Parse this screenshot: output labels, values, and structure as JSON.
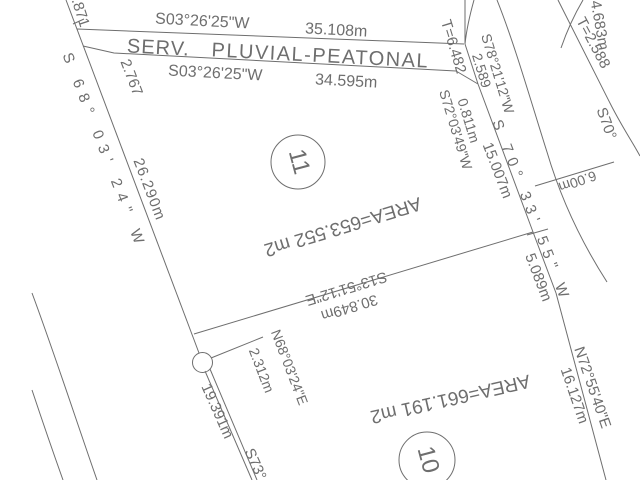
{
  "colors": {
    "line": "#6e6e6e",
    "text": "#6e6e6e",
    "background": "#ffffff"
  },
  "easement": {
    "name_1": "SERV.",
    "name_2": "PLUVIAL-PEATONAL",
    "north_bearing": "S03°26'25\"W",
    "north_distance": "35.108m",
    "south_bearing": "S03°26'25\"W",
    "south_distance": "34.595m"
  },
  "lots": [
    {
      "number": "11",
      "area": "AREA=653.552 m2"
    },
    {
      "number": "10",
      "area": "AREA=661.191 m2"
    }
  ],
  "measurements": {
    "west_cut_number": ".871",
    "west_bearing": "S 68° 03' 24\" W",
    "west_distance": "26.290m",
    "west_tie": "2.767",
    "corner_tangent": "T=6.482",
    "corner_bearing_1": "S78°21'12\"W",
    "corner_distance_1": "2.589",
    "corner_distance_2": "0.811m",
    "corner_bearing_2": "S72°03'49\"W",
    "east_bearing": "S 70° 33' 55\" W",
    "east_distance_1": "15.007m",
    "east_distance_2": "5.089m",
    "division_bearing": "S13°51'12\"E",
    "division_distance": "30.849m",
    "tie_bearing": "N68°03'24\"E",
    "tie_distance": "2.312m",
    "southwest_distance": "19.391m",
    "southwest_bearing_cut": "S73°",
    "southeast_bearing": "N72°55'40\"E",
    "southeast_distance": "16.127m",
    "road_tangent": "T=2.588",
    "road_arc_length": "4.683m",
    "road_bearing_cut": "S70°",
    "road_width": "6.00m"
  }
}
